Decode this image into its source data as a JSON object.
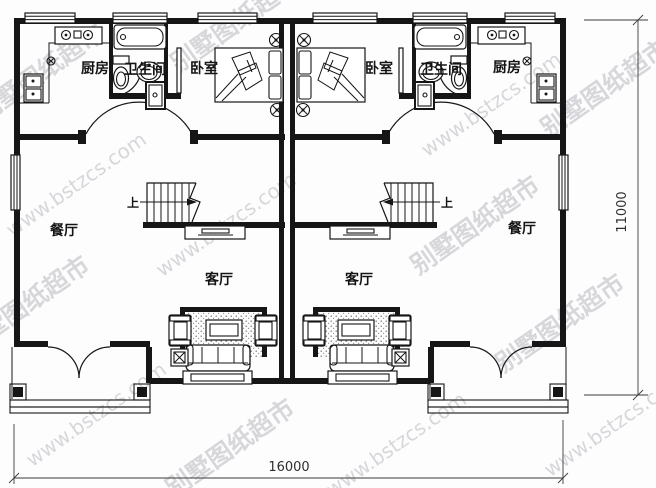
{
  "plan": {
    "rooms": {
      "kitchen": "厨房",
      "bathroom": "卫生间",
      "bedroom": "卧室",
      "dining": "餐厅",
      "living": "客厅"
    },
    "stairs": {
      "up": "上"
    },
    "dimensions": {
      "width": "16000",
      "height": "11000"
    },
    "watermark": {
      "brand": "别墅图纸超市",
      "url": "www.bstzcs.com"
    },
    "colors": {
      "line": "#161616",
      "watermark": "#b2b2ba",
      "background": "#fdfdfd"
    }
  }
}
